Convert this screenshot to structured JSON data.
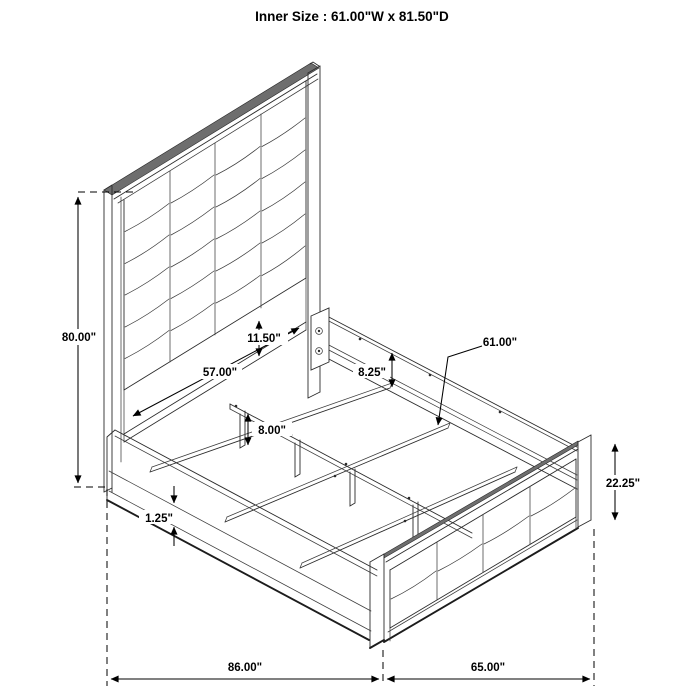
{
  "title": "Inner Size : 61.00\"W x 81.50\"D",
  "dimensions": {
    "headboard_height": "80.00\"",
    "headboard_gap": "11.50\"",
    "headboard_panel_width": "57.00\"",
    "rail_to_slat_depth": "8.25\"",
    "slat_length": "61.00\"",
    "support_leg_height": "8.00\"",
    "rail_trim_height": "1.25\"",
    "footboard_height": "22.25\"",
    "overall_depth": "86.00\"",
    "overall_width": "65.00\""
  }
}
